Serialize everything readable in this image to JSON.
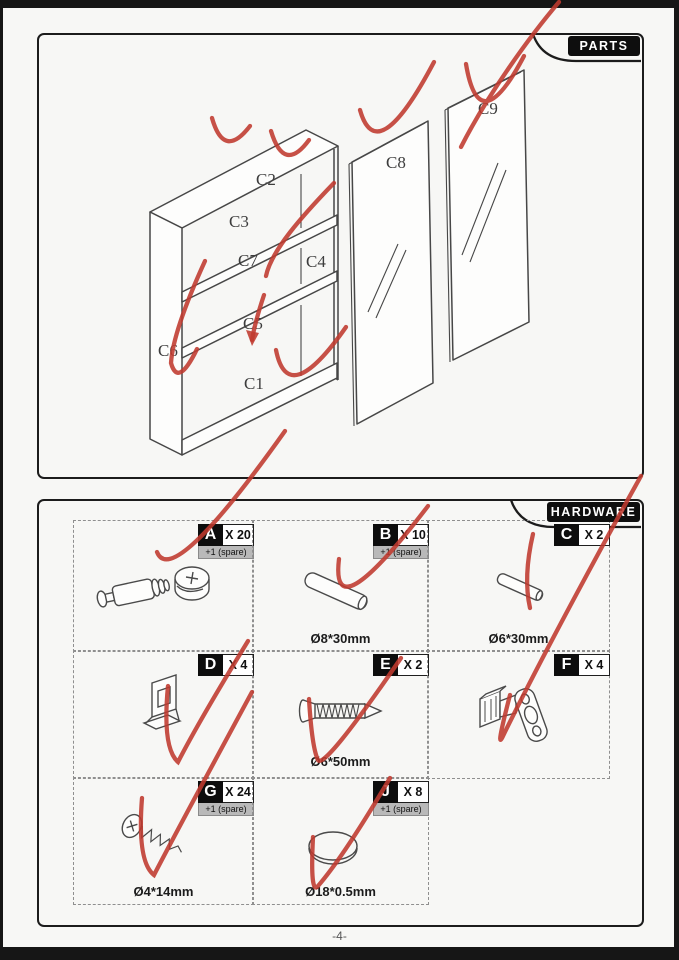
{
  "page": {
    "number": "-4-",
    "accent_red": "#c03a2f",
    "line_color": "#474747"
  },
  "parts_panel": {
    "title": "PARTS",
    "labels": [
      {
        "text": "C2"
      },
      {
        "text": "C3"
      },
      {
        "text": "C7"
      },
      {
        "text": "C4"
      },
      {
        "text": "C5"
      },
      {
        "text": "C6"
      },
      {
        "text": "C1"
      },
      {
        "text": "C8"
      },
      {
        "text": "C9"
      }
    ]
  },
  "hardware_panel": {
    "title": "HARDWARE",
    "items": [
      {
        "letter": "A",
        "count": "X 20",
        "spare": "+1  (spare)",
        "icon": "cam-bolt-and-lock"
      },
      {
        "letter": "B",
        "count": "X 10",
        "spare": "+1  (spare)",
        "size": "Ø8*30mm",
        "icon": "wooden-dowel"
      },
      {
        "letter": "C",
        "count": "X 2",
        "size": "Ø6*30mm",
        "icon": "metal-pin"
      },
      {
        "letter": "D",
        "count": "X 4",
        "icon": "shelf-support"
      },
      {
        "letter": "E",
        "count": "X 2",
        "size": "Ø6*50mm",
        "icon": "countersunk-screw"
      },
      {
        "letter": "F",
        "count": "X 4",
        "icon": "hinge"
      },
      {
        "letter": "G",
        "count": "X 24",
        "spare": "+1  (spare)",
        "size": "Ø4*14mm",
        "icon": "small-screw"
      },
      {
        "letter": "J",
        "count": "X 8",
        "spare": "+1  (spare)",
        "size": "Ø18*0.5mm",
        "icon": "cover-cap"
      }
    ]
  }
}
